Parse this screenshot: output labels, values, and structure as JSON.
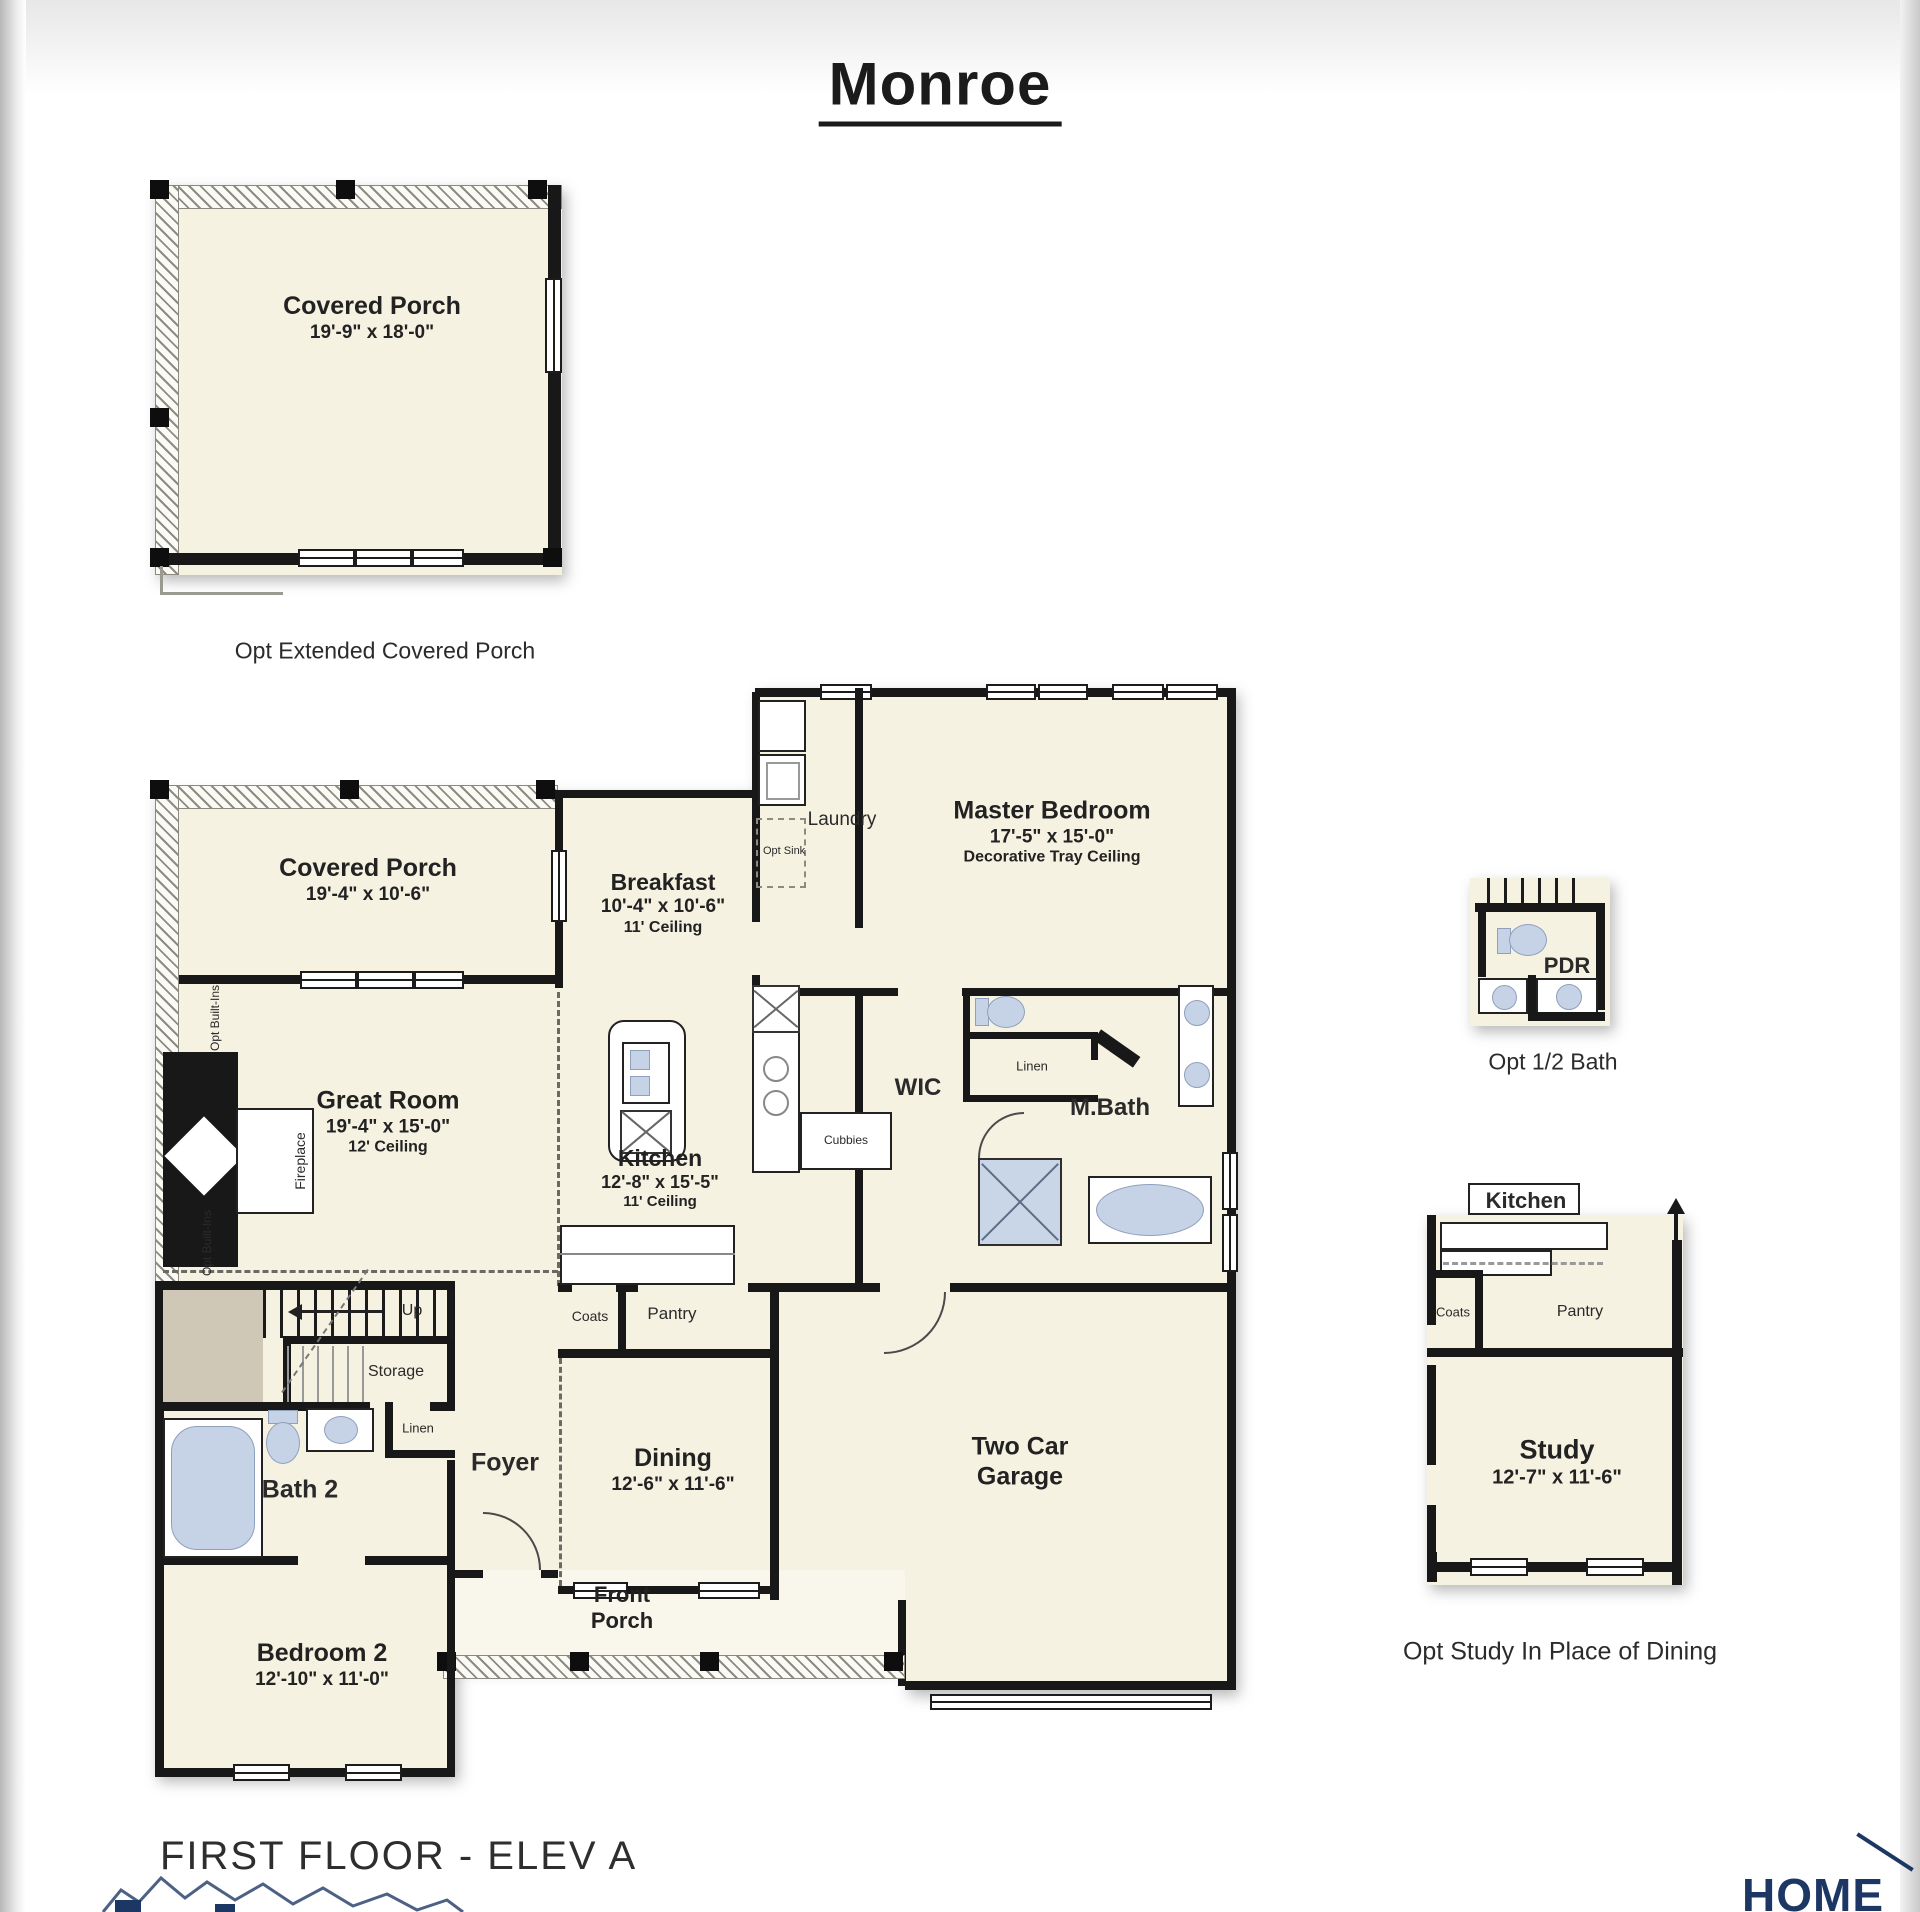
{
  "title": "Monroe",
  "footer": {
    "floor_label": "FIRST FLOOR - ELEV A",
    "brand": "HOME"
  },
  "colors": {
    "plan_fill": "#f6f2e2",
    "wall": "#181818",
    "fixture_blue": "#c6d3e6",
    "stair_taupe": "#cfc8b6",
    "brand_navy": "#1d3765"
  },
  "inset_extended_porch": {
    "name": "Covered Porch",
    "dims": "19'-9\" x 18'-0\"",
    "caption": "Opt Extended Covered Porch"
  },
  "main": {
    "covered_porch": {
      "name": "Covered Porch",
      "dims": "19'-4\" x 10'-6\""
    },
    "breakfast": {
      "name": "Breakfast",
      "dims": "10'-4\" x 10'-6\"",
      "note": "11' Ceiling"
    },
    "laundry": {
      "name": "Laundry",
      "opt_sink": "Opt Sink"
    },
    "master_bedroom": {
      "name": "Master Bedroom",
      "dims": "17'-5\" x 15'-0\"",
      "note": "Decorative Tray Ceiling"
    },
    "great_room": {
      "name": "Great Room",
      "dims": "19'-4\" x 15'-0\"",
      "note": "12' Ceiling"
    },
    "fireplace": "Fireplace",
    "opt_builtins": "Opt Built-Ins",
    "kitchen": {
      "name": "Kitchen",
      "dims": "12'-8\" x 15'-5\"",
      "note": "11' Ceiling"
    },
    "wic": "WIC",
    "cubbies": "Cubbies",
    "linen_master": "Linen",
    "mbath": "M.Bath",
    "up": "Up",
    "storage": "Storage",
    "linen_bath2": "Linen",
    "bath2": "Bath 2",
    "foyer": "Foyer",
    "coats": "Coats",
    "pantry": "Pantry",
    "dining": {
      "name": "Dining",
      "dims": "12'-6\" x 11'-6\""
    },
    "garage": "Two Car Garage",
    "bedroom2": {
      "name": "Bedroom 2",
      "dims": "12'-10\" x 11'-0\""
    },
    "front_porch": "Front Porch"
  },
  "inset_half_bath": {
    "name": "PDR",
    "caption": "Opt 1/2 Bath"
  },
  "inset_study": {
    "kitchen": "Kitchen",
    "coats": "Coats",
    "pantry": "Pantry",
    "name": "Study",
    "dims": "12'-7\" x 11'-6\"",
    "caption": "Opt Study In Place of Dining"
  }
}
